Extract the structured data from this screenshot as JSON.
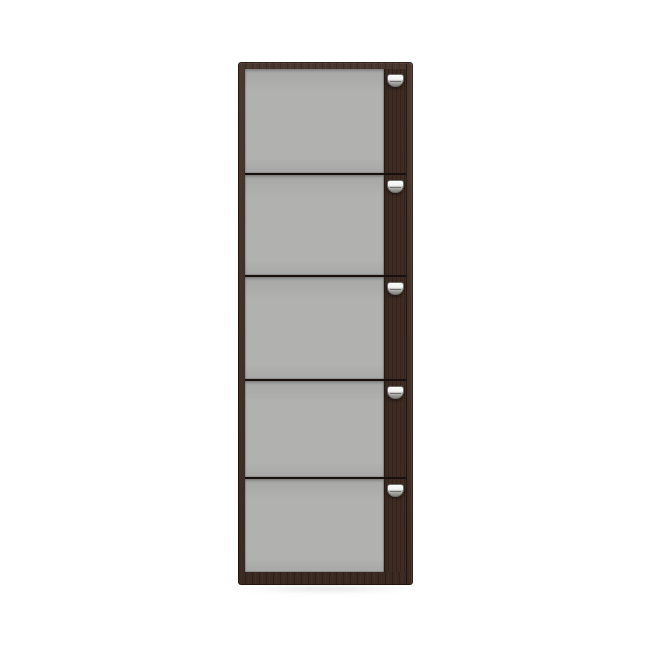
{
  "page": {
    "background_color": "#ffffff",
    "description": "Product render of a tall narrow storage cabinet with five gray-front doors, dark wenge wood frame and silver cup handles"
  },
  "cabinet": {
    "name": "five-door-storage-cabinet",
    "door_count": 5,
    "colors": {
      "page_bg": "#ffffff",
      "wood": "#3e2c24",
      "wood_dark_edge": "#1f1410",
      "gap_line": "#17100c",
      "panel_gray": "#b1b1af",
      "panel_gray_dark": "#a7a7a5",
      "handle_silver_light": "#fbfbf9",
      "handle_silver_dark": "#83837f",
      "handle_outline": "#6f6f6b",
      "shadow": "rgba(0,0,0,0.12)"
    },
    "doors": [
      {
        "id": 1,
        "handle": "cup-handle"
      },
      {
        "id": 2,
        "handle": "cup-handle"
      },
      {
        "id": 3,
        "handle": "cup-handle"
      },
      {
        "id": 4,
        "handle": "cup-handle"
      },
      {
        "id": 5,
        "handle": "cup-handle"
      }
    ]
  }
}
